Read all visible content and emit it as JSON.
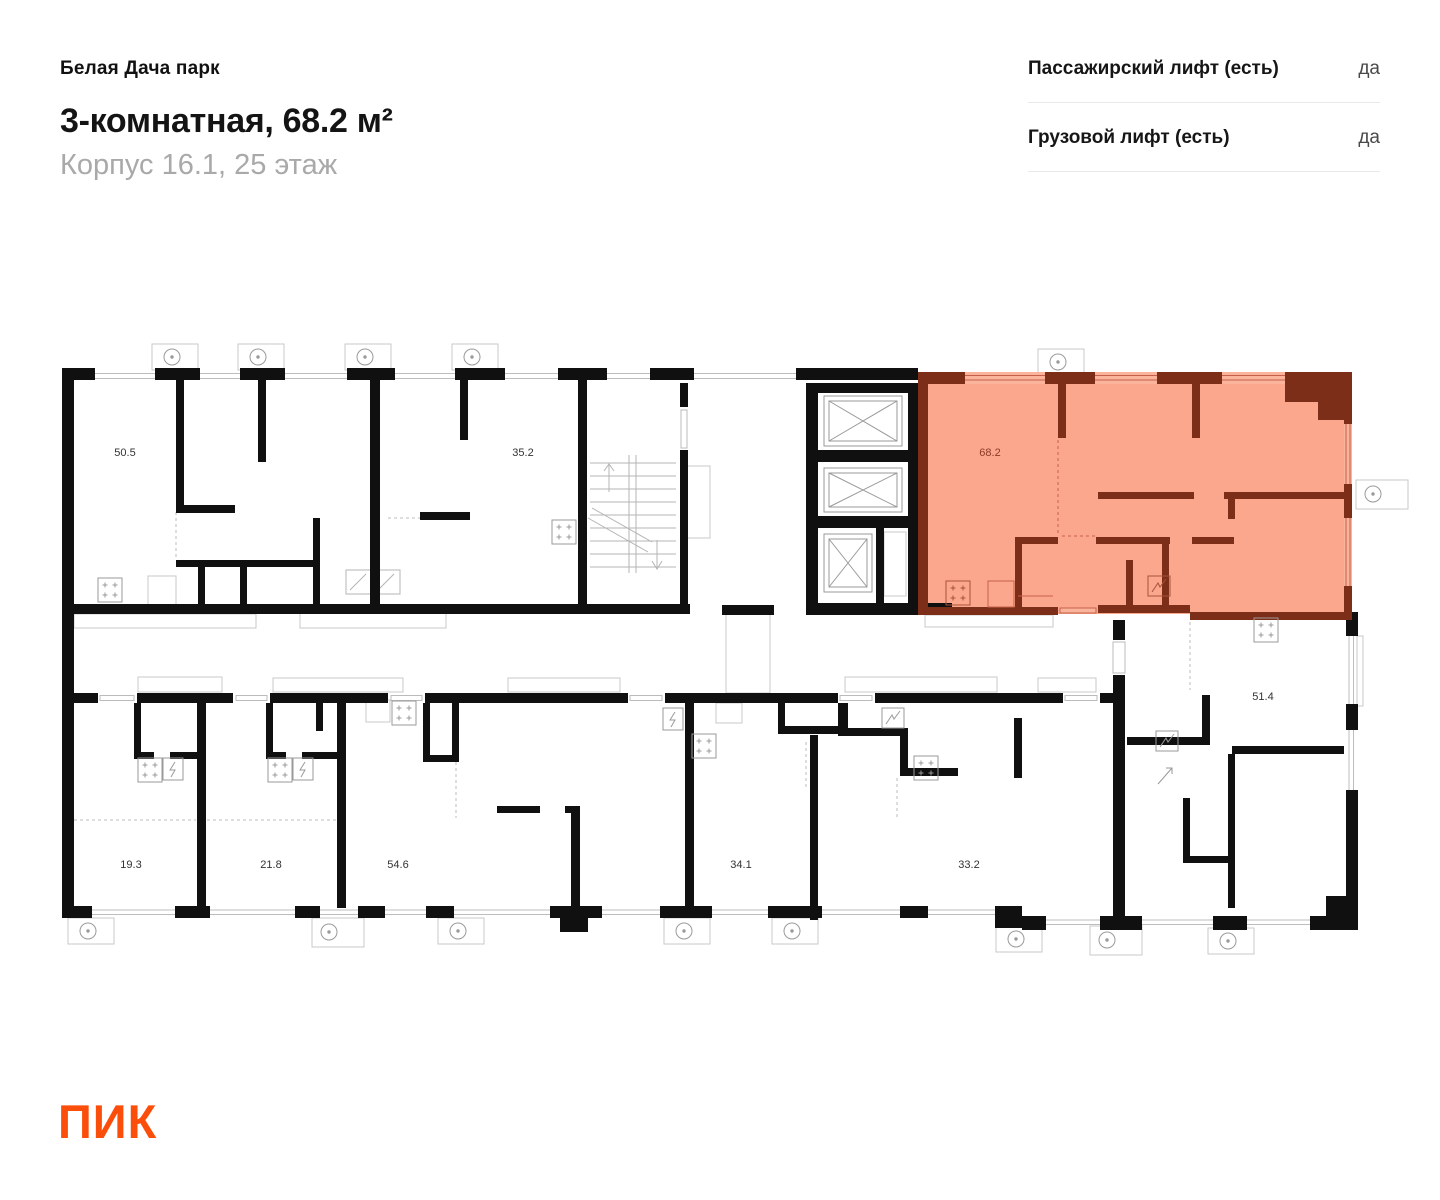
{
  "header": {
    "project": "Белая Дача парк",
    "title": "3-комнатная, 68.2 м²",
    "subtitle": "Корпус 16.1, 25 этаж"
  },
  "lifts": {
    "rows": [
      {
        "label": "Пассажирский лифт (есть)",
        "value": "да"
      },
      {
        "label": "Грузовой лифт (есть)",
        "value": "да"
      }
    ]
  },
  "plan": {
    "highlighted_unit": {
      "area": "68.2"
    },
    "units": [
      {
        "area": "50.5",
        "highlighted": false
      },
      {
        "area": "35.2",
        "highlighted": false
      },
      {
        "area": "68.2",
        "highlighted": true
      },
      {
        "area": "19.3",
        "highlighted": false
      },
      {
        "area": "21.8",
        "highlighted": false
      },
      {
        "area": "54.6",
        "highlighted": false
      },
      {
        "area": "34.1",
        "highlighted": false
      },
      {
        "area": "33.2",
        "highlighted": false
      },
      {
        "area": "51.4",
        "highlighted": false
      }
    ],
    "icons": {
      "ac_unit": "ac-unit-icon",
      "stove": "stove-icon",
      "electric_panel": "electric-panel-icon",
      "washing_machine": "washing-machine-icon",
      "stairs": "stairs-icon",
      "elevator": "elevator-shaft-icon"
    }
  },
  "colors": {
    "wall": "#101010",
    "highlight_fill": "#FBA78E",
    "highlight_wall": "#7D2E19",
    "accent": "#FC4C02"
  },
  "logo": {
    "text": "ПИК"
  }
}
